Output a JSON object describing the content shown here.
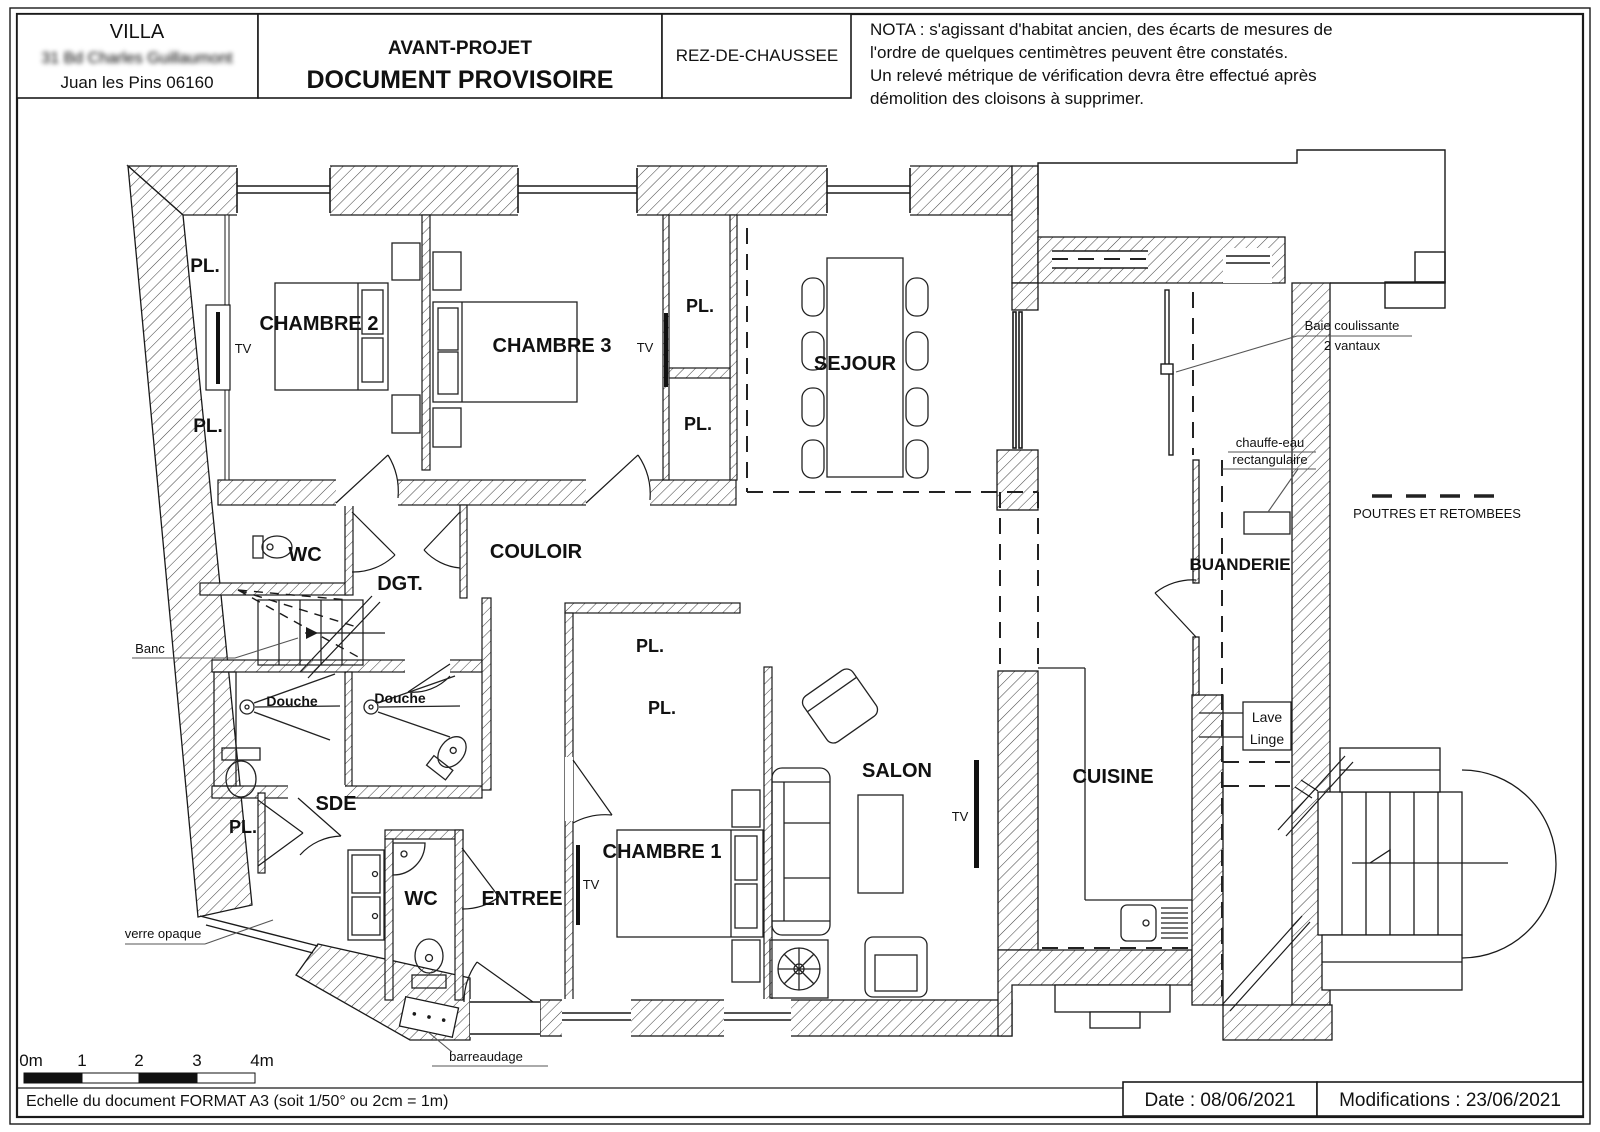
{
  "colors": {
    "line": "#1a1a1a",
    "accent_red": "#e8000a",
    "hatch": "#444444"
  },
  "header": {
    "villa_title": "VILLA",
    "villa_address": "31 Bd Charles Guillaumont",
    "villa_city": "Juan les Pins 06160",
    "project_line1": "AVANT-PROJET",
    "project_line2": "DOCUMENT PROVISOIRE",
    "level": "REZ-DE-CHAUSSEE",
    "nota_line1": "NOTA : s'agissant d'habitat ancien, des écarts de mesures de",
    "nota_line2": "l'ordre de quelques centimètres peuvent être constatés.",
    "nota_line3": "Un relevé métrique de vérification devra être effectué après",
    "nota_line4": "démolition des cloisons à supprimer."
  },
  "plan": {
    "labels": [
      {
        "id": "label-pl-topleft-1",
        "text": "PL.",
        "x": 205,
        "y": 272,
        "size": 19,
        "bold": true
      },
      {
        "id": "label-pl-topleft-2",
        "text": "PL.",
        "x": 208,
        "y": 432,
        "size": 19,
        "bold": true
      },
      {
        "id": "label-tv-chambre2",
        "text": "TV",
        "x": 243,
        "y": 353,
        "size": 13,
        "bold": false
      },
      {
        "id": "label-chambre2",
        "text": "CHAMBRE 2",
        "x": 319,
        "y": 330,
        "size": 20,
        "bold": true
      },
      {
        "id": "label-chambre3",
        "text": "CHAMBRE 3",
        "x": 552,
        "y": 352,
        "size": 20,
        "bold": true
      },
      {
        "id": "label-tv-chambre3",
        "text": "TV",
        "x": 645,
        "y": 352,
        "size": 13,
        "bold": false
      },
      {
        "id": "label-pl-mid-1",
        "text": "PL.",
        "x": 700,
        "y": 312,
        "size": 18,
        "bold": true
      },
      {
        "id": "label-pl-mid-2",
        "text": "PL.",
        "x": 698,
        "y": 430,
        "size": 18,
        "bold": true
      },
      {
        "id": "label-sejour",
        "text": "SEJOUR",
        "x": 855,
        "y": 370,
        "size": 20,
        "bold": true
      },
      {
        "id": "label-wc-top",
        "text": "WC",
        "x": 305,
        "y": 561,
        "size": 20,
        "bold": true
      },
      {
        "id": "label-dgt",
        "text": "DGT.",
        "x": 400,
        "y": 590,
        "size": 20,
        "bold": true
      },
      {
        "id": "label-couloir",
        "text": "COULOIR",
        "x": 536,
        "y": 558,
        "size": 20,
        "bold": true
      },
      {
        "id": "label-banc",
        "text": "Banc",
        "x": 150,
        "y": 653,
        "size": 13,
        "bold": false
      },
      {
        "id": "label-douche-1",
        "text": "Douche",
        "x": 292,
        "y": 706,
        "size": 14,
        "bold": true
      },
      {
        "id": "label-douche-2",
        "text": "Douche",
        "x": 400,
        "y": 703,
        "size": 14,
        "bold": true
      },
      {
        "id": "label-sde",
        "text": "SDE",
        "x": 336,
        "y": 810,
        "size": 20,
        "bold": true
      },
      {
        "id": "label-pl-sde",
        "text": "PL.",
        "x": 243,
        "y": 833,
        "size": 18,
        "bold": true
      },
      {
        "id": "label-verre-opaque",
        "text": "verre opaque",
        "x": 163,
        "y": 938,
        "size": 13,
        "bold": false
      },
      {
        "id": "label-wc-bottom",
        "text": "WC",
        "x": 421,
        "y": 905,
        "size": 20,
        "bold": true
      },
      {
        "id": "label-entree",
        "text": "ENTREE",
        "x": 522,
        "y": 905,
        "size": 20,
        "bold": true
      },
      {
        "id": "label-tv-chambre1",
        "text": "TV",
        "x": 591,
        "y": 889,
        "size": 13,
        "bold": false
      },
      {
        "id": "label-chambre1",
        "text": "CHAMBRE 1",
        "x": 662,
        "y": 858,
        "size": 20,
        "bold": true
      },
      {
        "id": "label-pl-ch1-1",
        "text": "PL.",
        "x": 650,
        "y": 652,
        "size": 18,
        "bold": true
      },
      {
        "id": "label-pl-ch1-2",
        "text": "PL.",
        "x": 662,
        "y": 714,
        "size": 18,
        "bold": true
      },
      {
        "id": "label-salon",
        "text": "SALON",
        "x": 897,
        "y": 777,
        "size": 20,
        "bold": true
      },
      {
        "id": "label-tv-salon",
        "text": "TV",
        "x": 960,
        "y": 821,
        "size": 13,
        "bold": false
      },
      {
        "id": "label-cuisine",
        "text": "CUISINE",
        "x": 1113,
        "y": 783,
        "size": 20,
        "bold": true
      },
      {
        "id": "label-buanderie",
        "text": "BUANDERIE",
        "x": 1240,
        "y": 570,
        "size": 17,
        "bold": true
      },
      {
        "id": "label-lave",
        "text": "Lave",
        "x": 1267,
        "y": 722,
        "size": 14,
        "bold": false
      },
      {
        "id": "label-linge",
        "text": "Linge",
        "x": 1267,
        "y": 744,
        "size": 14,
        "bold": false
      },
      {
        "id": "label-baie-1",
        "text": "Baie coulissante",
        "x": 1352,
        "y": 330,
        "size": 13,
        "bold": false
      },
      {
        "id": "label-baie-2",
        "text": "2 vantaux",
        "x": 1352,
        "y": 350,
        "size": 13,
        "bold": false
      },
      {
        "id": "label-chauffe-1",
        "text": "chauffe-eau",
        "x": 1270,
        "y": 447,
        "size": 13,
        "bold": false
      },
      {
        "id": "label-chauffe-2",
        "text": "rectangulaire",
        "x": 1270,
        "y": 464,
        "size": 13,
        "bold": false
      },
      {
        "id": "label-poutres",
        "text": "POUTRES ET RETOMBEES",
        "x": 1437,
        "y": 518,
        "size": 13,
        "bold": false
      },
      {
        "id": "label-barreaudage",
        "text": "barreaudage",
        "x": 486,
        "y": 1061,
        "size": 13,
        "bold": false
      }
    ]
  },
  "scalebar": {
    "t0": "0m",
    "t1": "1",
    "t2": "2",
    "t3": "3",
    "t4": "4m",
    "caption": "Echelle du document FORMAT A3 (soit 1/50° ou 2cm = 1m)"
  },
  "footer": {
    "date": "Date : 08/06/2021",
    "modifications": "Modifications : 23/06/2021"
  }
}
